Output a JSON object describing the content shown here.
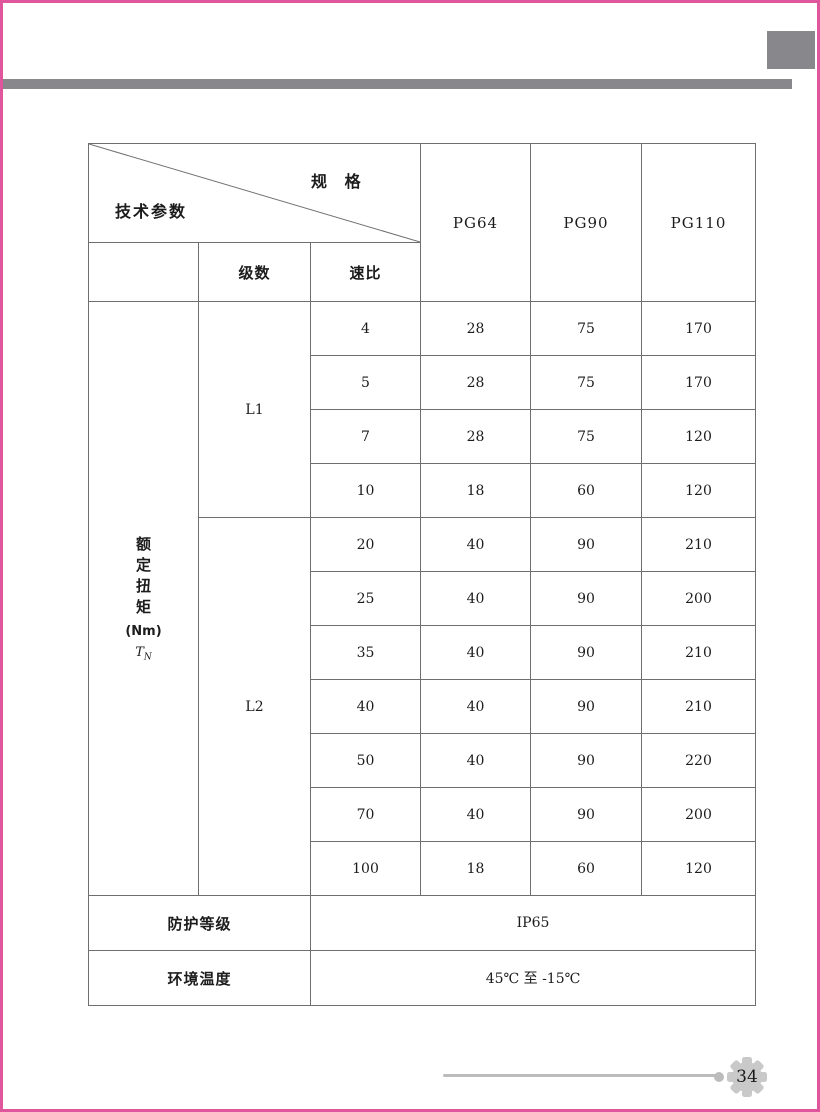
{
  "table": {
    "corner": {
      "top_label": "规 格",
      "bottom_label": "技术参数"
    },
    "spec_columns": [
      "PG64",
      "PG90",
      "PG110"
    ],
    "sub_headers": {
      "stage": "级数",
      "ratio": "速比"
    },
    "torque_label": {
      "vertical": "额定扭矩",
      "unit": "(Nm)",
      "symbol": "T",
      "symbol_sub": "N"
    },
    "groups": [
      {
        "stage": "L1",
        "rows": [
          {
            "ratio": "4",
            "pg64": "28",
            "pg90": "75",
            "pg110": "170"
          },
          {
            "ratio": "5",
            "pg64": "28",
            "pg90": "75",
            "pg110": "170"
          },
          {
            "ratio": "7",
            "pg64": "28",
            "pg90": "75",
            "pg110": "120"
          },
          {
            "ratio": "10",
            "pg64": "18",
            "pg90": "60",
            "pg110": "120"
          }
        ]
      },
      {
        "stage": "L2",
        "rows": [
          {
            "ratio": "20",
            "pg64": "40",
            "pg90": "90",
            "pg110": "210"
          },
          {
            "ratio": "25",
            "pg64": "40",
            "pg90": "90",
            "pg110": "200"
          },
          {
            "ratio": "35",
            "pg64": "40",
            "pg90": "90",
            "pg110": "210"
          },
          {
            "ratio": "40",
            "pg64": "40",
            "pg90": "90",
            "pg110": "210"
          },
          {
            "ratio": "50",
            "pg64": "40",
            "pg90": "90",
            "pg110": "220"
          },
          {
            "ratio": "70",
            "pg64": "40",
            "pg90": "90",
            "pg110": "200"
          },
          {
            "ratio": "100",
            "pg64": "18",
            "pg90": "60",
            "pg110": "120"
          }
        ]
      }
    ],
    "footer_rows": [
      {
        "label": "防护等级",
        "value": "IP65"
      },
      {
        "label": "环境温度",
        "value": "45℃ 至 -15℃"
      }
    ]
  },
  "footer": {
    "page_number": "34"
  },
  "colors": {
    "accent_pink": "#e0569c",
    "decor_gray": "#88878b",
    "cell_shade": "#d9d5d0",
    "table_line": "#6f6f6f"
  }
}
